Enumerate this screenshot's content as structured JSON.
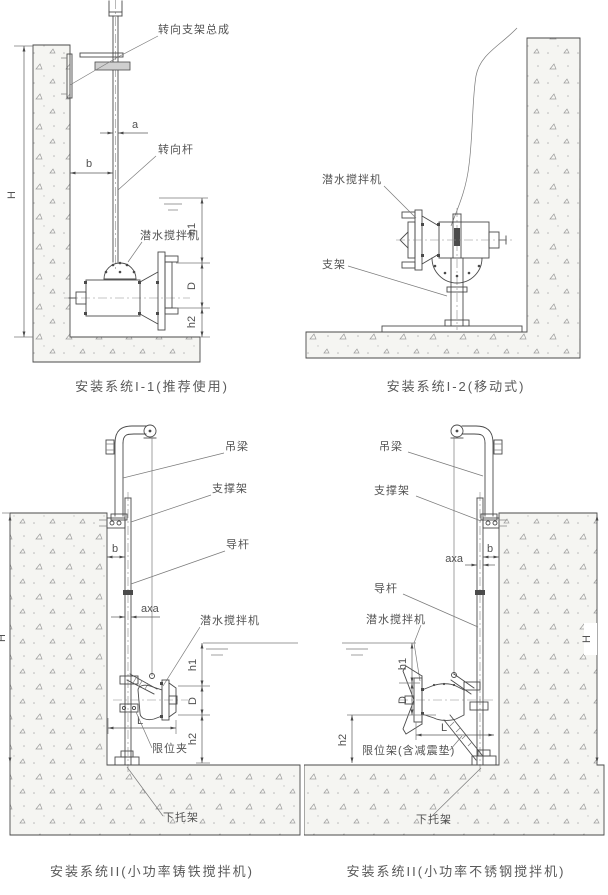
{
  "drawing": {
    "panels": [
      {
        "caption": "安装系统I-1(推荐使用)",
        "labels": {
          "steering_bracket_assembly": "转向支架总成",
          "steering_rod": "转向杆",
          "submersible_mixer": "潜水搅拌机"
        },
        "dims": {
          "H": "H",
          "a": "a",
          "b": "b",
          "h1": "h1",
          "D": "D",
          "h2": "h2"
        }
      },
      {
        "caption": "安装系统I-2(移动式)",
        "labels": {
          "submersible_mixer": "潜水搅拌机",
          "stand": "支架"
        }
      },
      {
        "caption": "安装系统II(小功率铸铁搅拌机)",
        "labels": {
          "hanging_beam": "吊梁",
          "support_frame": "支撑架",
          "guide_rod": "导杆",
          "submersible_mixer": "潜水搅拌机",
          "limit_clamp": "限位夹",
          "lower_bracket": "下托架"
        },
        "dims": {
          "H": "H",
          "b": "b",
          "axa": "axa",
          "h1": "h1",
          "D": "D",
          "h2": "h2",
          "L": "L"
        }
      },
      {
        "caption": "安装系统II(小功率不锈钢搅拌机)",
        "labels": {
          "hanging_beam": "吊梁",
          "support_frame": "支撑架",
          "guide_rod": "导杆",
          "submersible_mixer": "潜水搅拌机",
          "limit_frame": "限位架(含减震垫)",
          "lower_bracket": "下托架"
        },
        "dims": {
          "H": "H",
          "b": "b",
          "axa": "axa",
          "h1": "h1",
          "D": "D",
          "h2": "h2",
          "L": "L"
        }
      }
    ]
  }
}
